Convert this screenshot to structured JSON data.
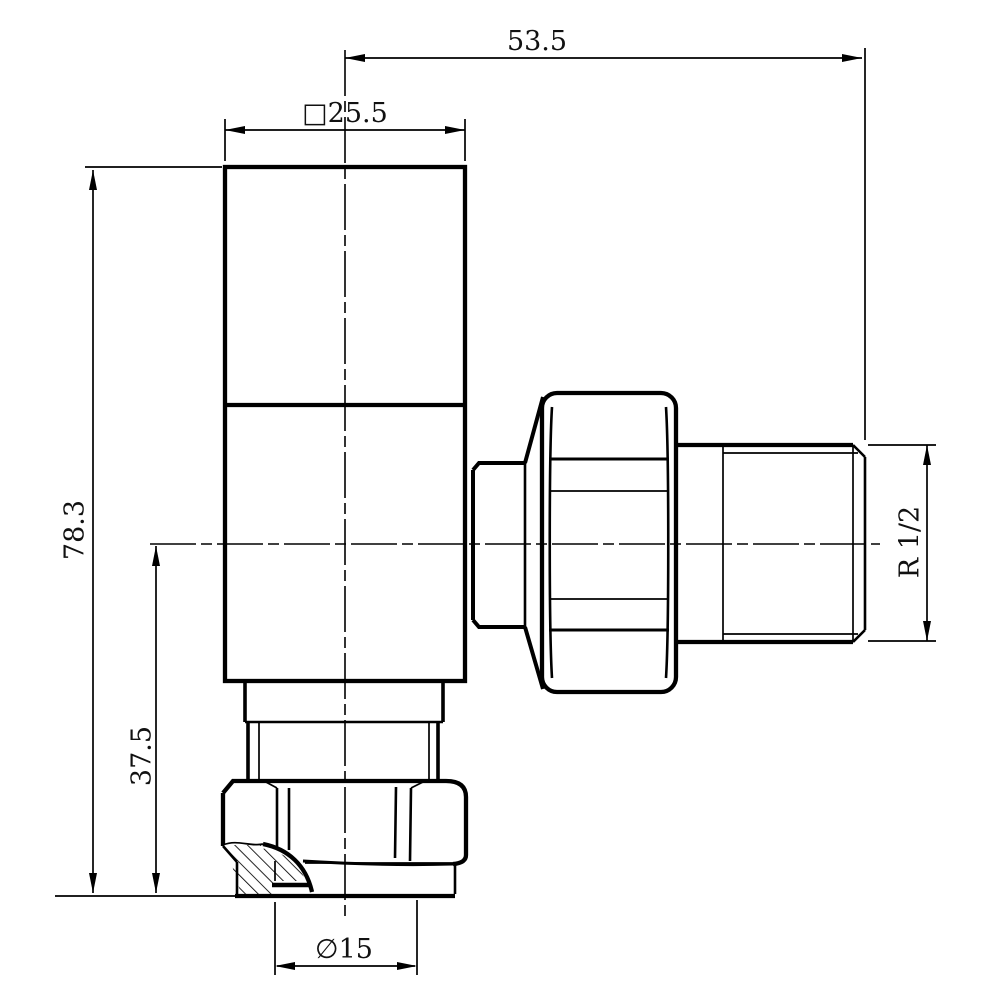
{
  "page": {
    "background": "#ffffff"
  },
  "drawing": {
    "stroke_color": "#000000",
    "dimensions": {
      "span": "53.5",
      "head_width": "□25.5",
      "height_overall": "78.3",
      "height_lower": "37.5",
      "thread": "R 1/2",
      "bore": "∅15"
    }
  }
}
